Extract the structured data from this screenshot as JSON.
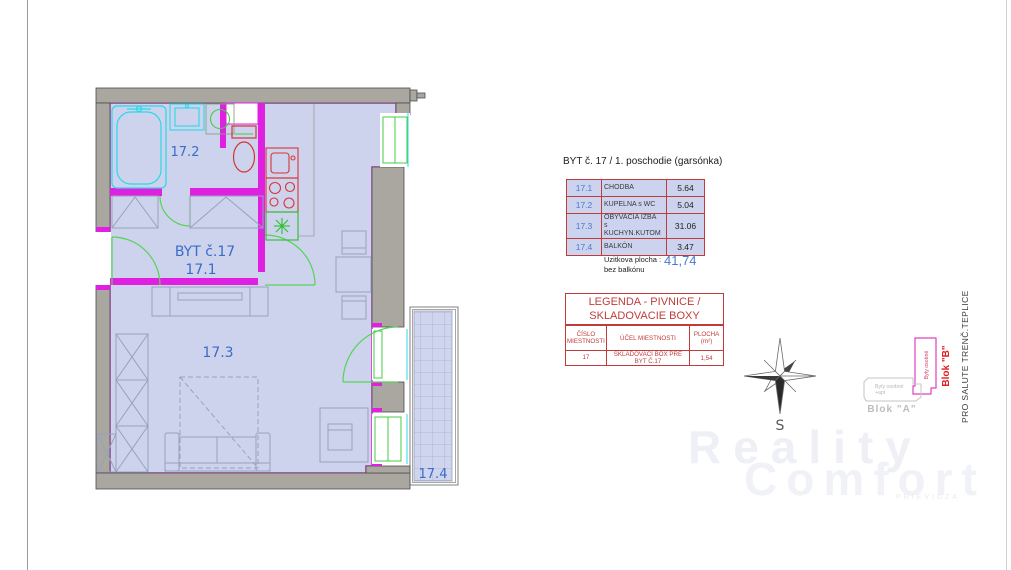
{
  "plan": {
    "apartment_label": "BYT č.17",
    "room_labels": {
      "r171": "17.1",
      "r172": "17.2",
      "r173": "17.3",
      "r174": "17.4"
    }
  },
  "area_table": {
    "title": "BYT č. 17 / 1. poschodie  (garsónka)",
    "rows": [
      {
        "num": "17.1",
        "name": "CHODBA",
        "name2": "",
        "area": "5.64"
      },
      {
        "num": "17.2",
        "name": "KUPELNA s WC",
        "name2": "",
        "area": "5.04"
      },
      {
        "num": "17.3",
        "name": "OBYVACIA IZBA",
        "name2": "s KUCHYN.KUTOM",
        "area": "31.06"
      },
      {
        "num": "17.4",
        "name": "BALKÓN",
        "name2": "",
        "area": "3.47"
      }
    ],
    "footer_label1": "Uzitkova plocha :",
    "footer_label2": "bez balkónu",
    "total": "41,74"
  },
  "legend_table": {
    "title_line1": "LEGENDA - PIVNICE /",
    "title_line2": "SKLADOVACIE BOXY",
    "header_num1": "ČÍSLO",
    "header_num2": "MIESTNOSTI",
    "header_purpose": "ÚČEL MIESTNOSTI",
    "header_area": "PLOCHA (m²)",
    "row": {
      "num": "17",
      "purpose": "SKLADOVACÍ BOX PRE BYT Č.17",
      "area": "1,54"
    }
  },
  "compass": {
    "south_label": "S"
  },
  "blocks": {
    "blok_a": {
      "label": "Blok \"A\"",
      "desc1": "Byty osobné",
      "desc2": "+apt"
    },
    "blok_b": {
      "label": "Blok \"B\"",
      "desc": "Byty osobné"
    }
  },
  "side_text": "PRO SALUTE TRENČ.TEPLICE",
  "watermark": {
    "line1": "Reality",
    "line2": "Comfort",
    "line3": "PRIEVIDZA"
  }
}
